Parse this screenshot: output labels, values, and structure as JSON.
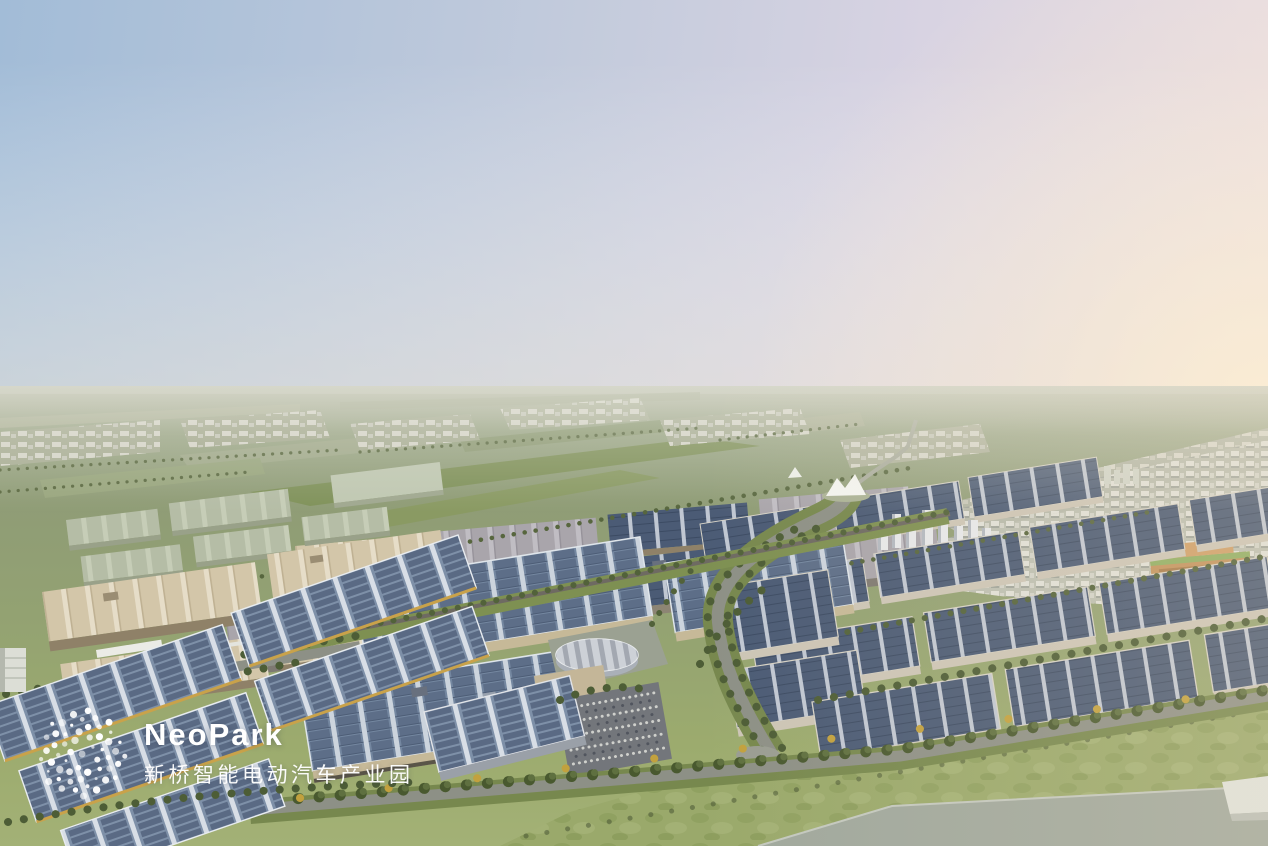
{
  "image": {
    "kind": "aerial-architectural-rendering",
    "alt": "Dusk aerial masterplan rendering of NeoPark, a smart electric-vehicle industrial park with solar-roofed factory halls, solar carports, tree-lined avenues, a residential district and green fields stretching to the horizon"
  },
  "logo": {
    "wordmark": "NeoPark",
    "subtitle_zh": "新桥智能电动汽车产业园",
    "mark": "dot-globe-icon",
    "text_color": "#ffffff"
  },
  "palette": {
    "sky_blue": "#a2bcd7",
    "sky_lavender": "#d8d3e2",
    "sun_glow": "#f9ecd6",
    "horizon_haze": "#c2c4b4",
    "field_green": "#93a07e",
    "lawn_green": "#9aa96b",
    "tree_green": "#4c5c37",
    "solar_panel_dark": "#55657f",
    "solar_panel_light": "#9fb0c2",
    "tan_roof": "#d3c6a9",
    "tan_wall": "#c6b998",
    "road_gray": "#8d9086",
    "gold_beam": "#c9a24a"
  },
  "scene": {
    "elements": [
      "sky",
      "sun-glow",
      "horizon-haze",
      "distant-fields",
      "distant-towns",
      "residential-district",
      "tower-cluster",
      "tent-canopy",
      "round-exhibition-hall",
      "factory-halls",
      "solar-roof-warehouses",
      "solar-carports",
      "tree-lined-avenue",
      "boulevard",
      "parking-lot",
      "lawn",
      "concrete-pad",
      "footbridge"
    ]
  }
}
